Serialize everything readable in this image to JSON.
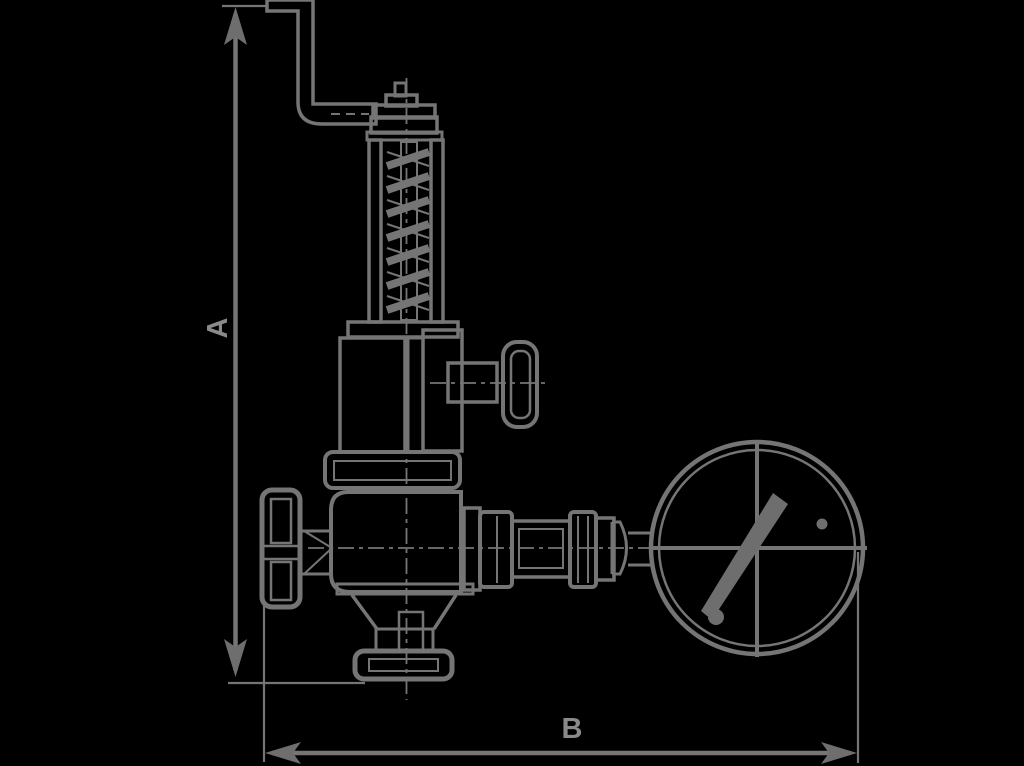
{
  "title": "Safety relief valve with pressure gauge - dimensioned outline drawing",
  "canvas": {
    "width": 1024,
    "height": 766,
    "background_color": "#000000",
    "line_color": "#757575",
    "fill_color": "#6e6e6e",
    "label_color": "#8a8a8a"
  },
  "dimensions": {
    "vertical_label": "A",
    "horizontal_label": "B"
  },
  "parts": [
    "dimension-a",
    "dimension-b",
    "test-lever",
    "valve-cap",
    "spring-housing",
    "spring",
    "side-knob",
    "union-nut",
    "handwheel",
    "valve-body",
    "inlet-union",
    "outlet-piping",
    "pressure-gauge",
    "gauge-needle"
  ]
}
